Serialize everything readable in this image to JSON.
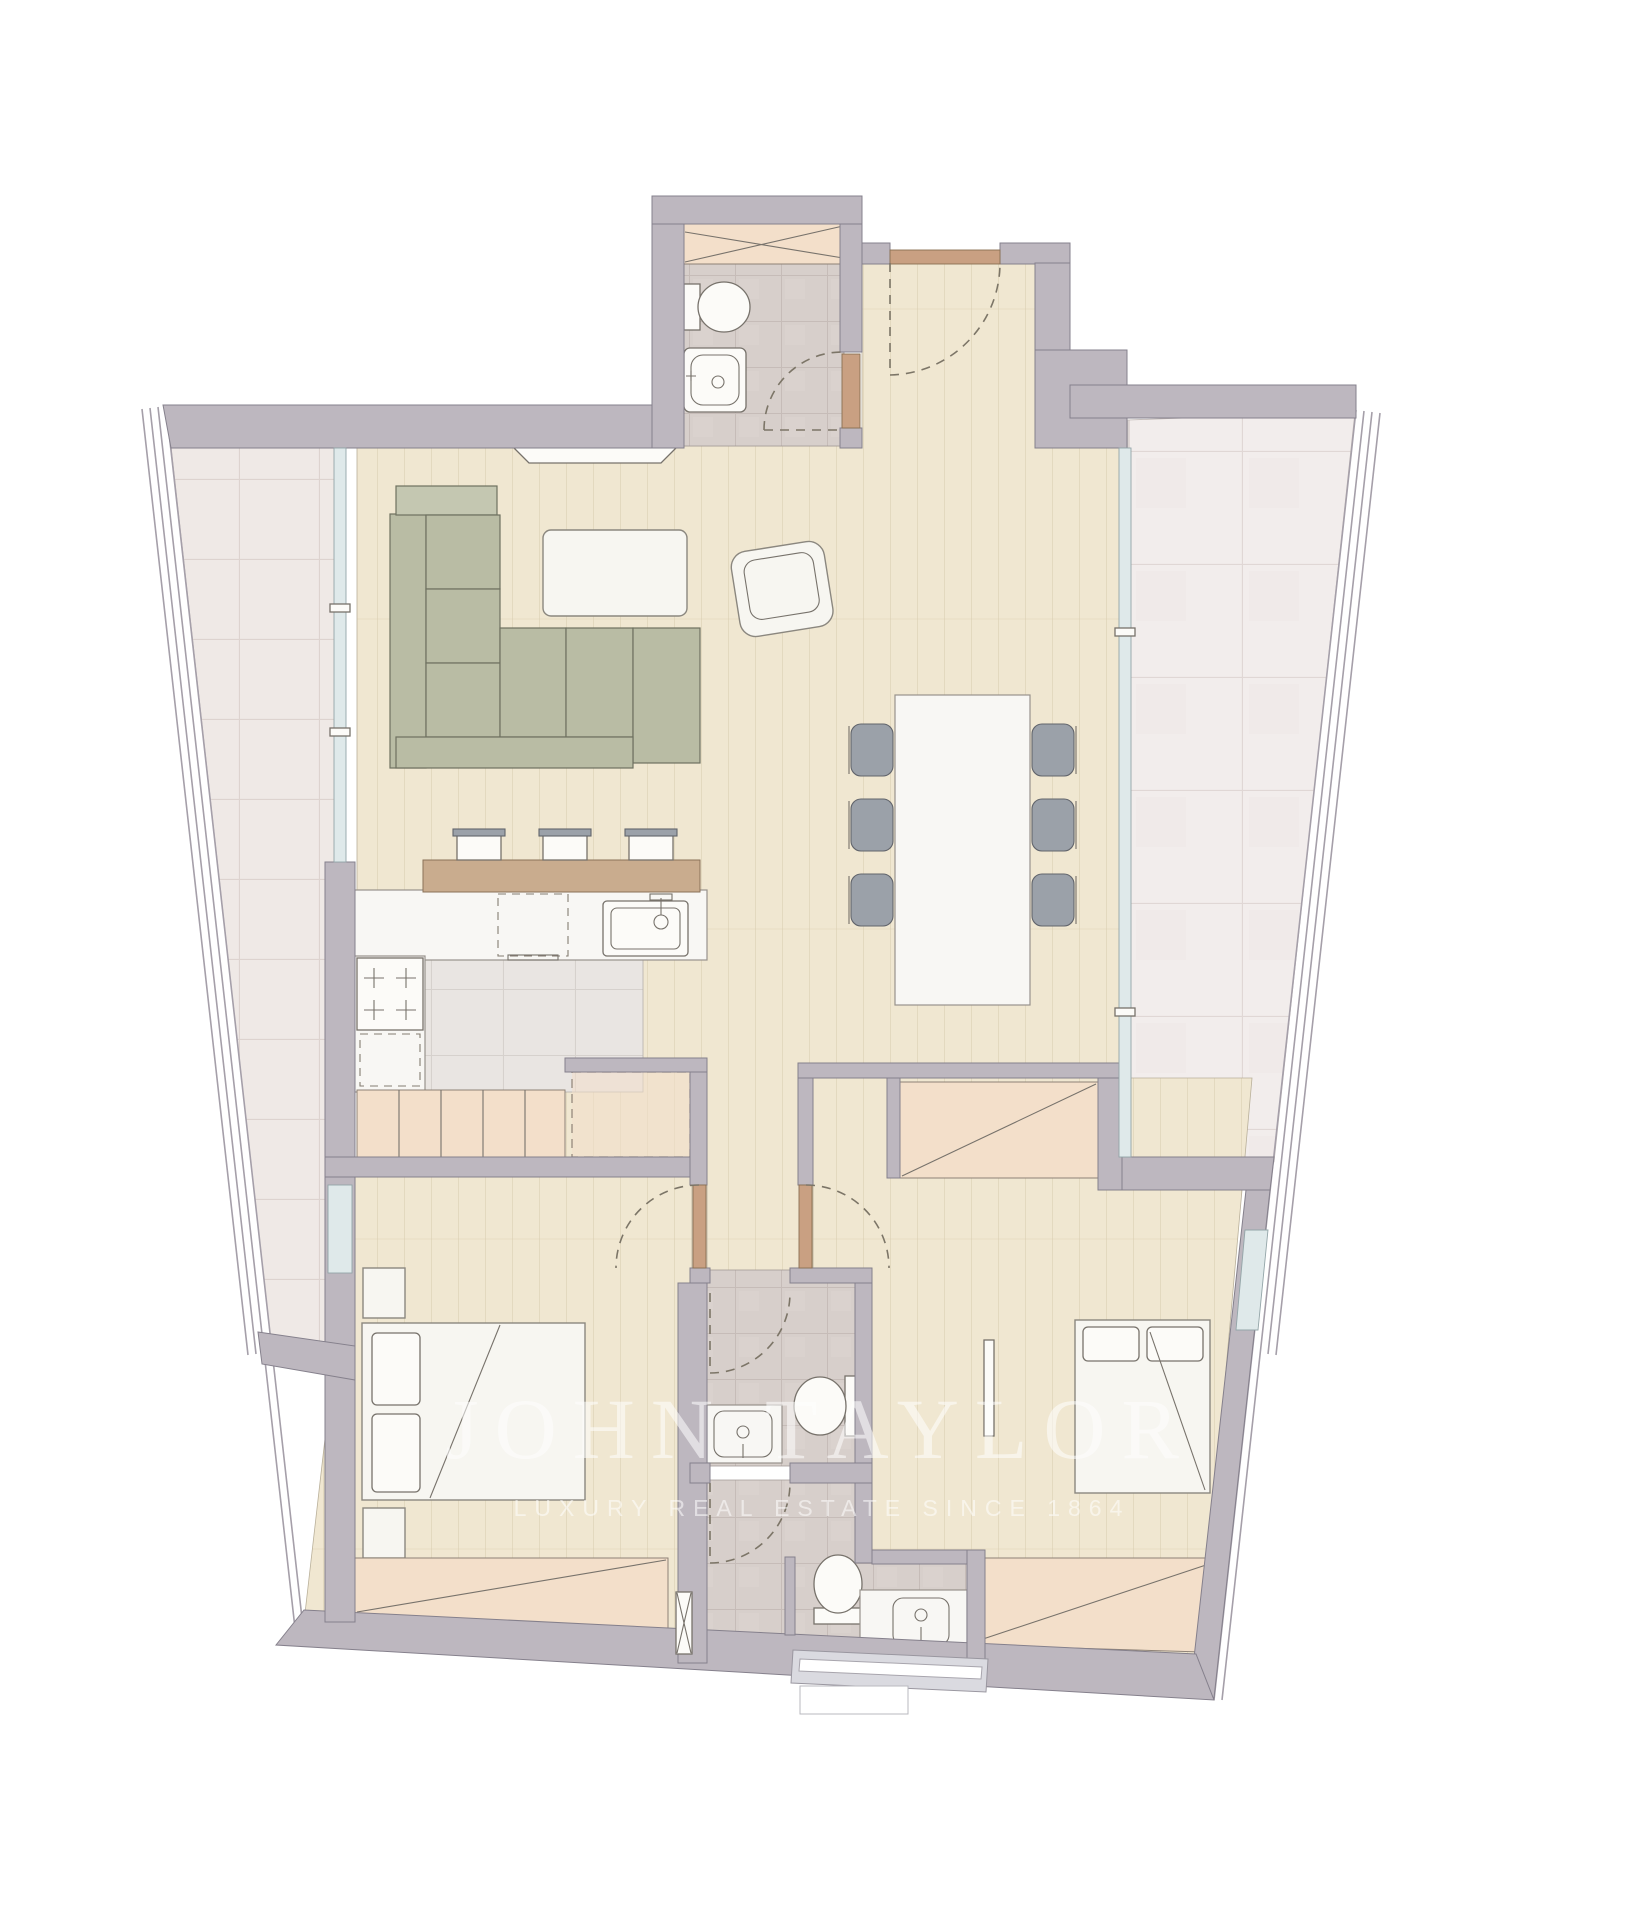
{
  "watermark": {
    "line1": "JOHN TAYLOR",
    "line2": "LUXURY REAL ESTATE SINCE 1864"
  },
  "palette": {
    "wall": "#bdb7bf",
    "wall_stroke": "#85808c",
    "wood_floor": "#f0e7d1",
    "terrace_tile": "#efe9e6",
    "bath_tile": "#d7cfcb",
    "kitchen_tile": "#e9e5e2",
    "marble": "#f8f7f4",
    "cabinet_peach": "#f3dfca",
    "sofa_sage": "#b9bca4",
    "chair_gray": "#9ba1a9",
    "door_tan": "#c9a082",
    "bar_wood": "#c9ac8e",
    "glass": "#dfe9ea",
    "white_furniture": "#f7f6f1"
  }
}
